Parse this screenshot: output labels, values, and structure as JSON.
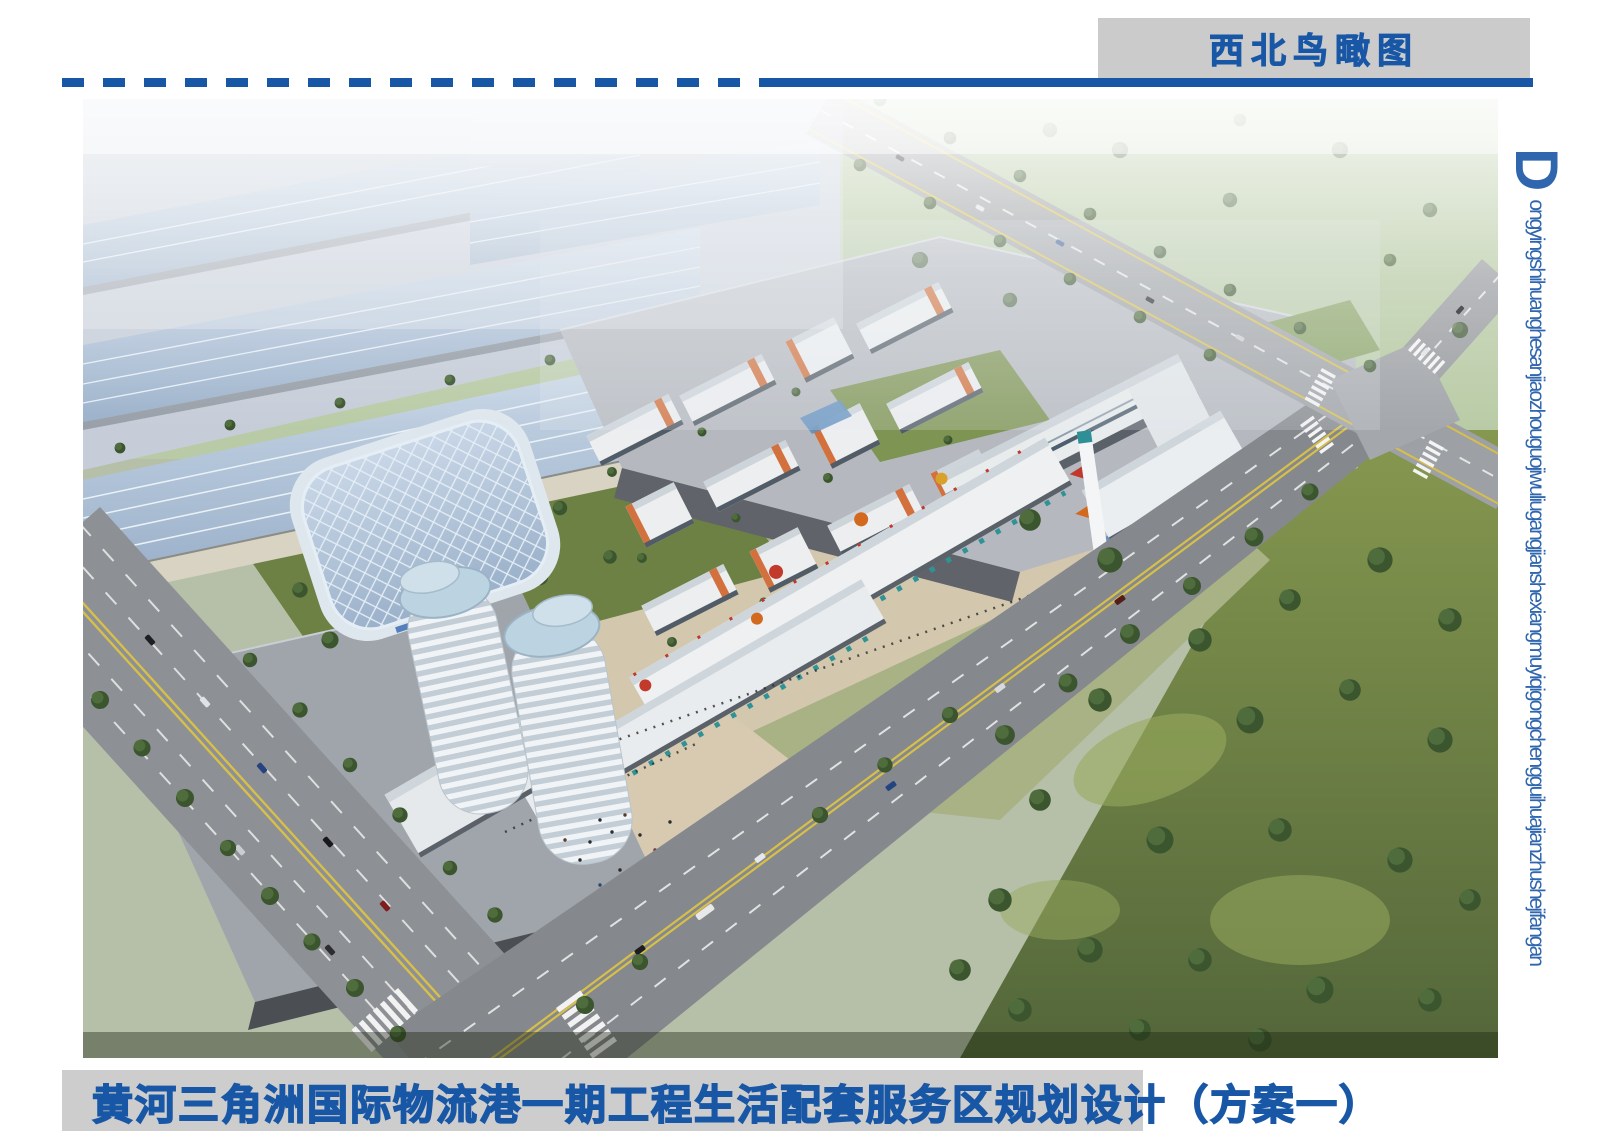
{
  "header": {
    "view_label": "西北鸟瞰图",
    "bar_color": "#cbcbcb",
    "accent_color": "#1856a6"
  },
  "divider": {
    "color": "#1856a6",
    "style": "dashed-then-solid"
  },
  "side_caption": {
    "initial": "D",
    "pinyin": "ongyingshihuanghesanjiaozhouguojiwuliugangjianshexiangmuyiqigongchengguihuajianzhushejifangan",
    "color": "#2f66ae"
  },
  "footer": {
    "project_title": "黄河三角洲国际物流港一期工程生活配套服务区规划设计（方案一）",
    "text_color": "#1856a6",
    "bar_color": "#cdcdcd"
  },
  "rendering": {
    "description": "西北鸟瞰图 — 生活配套服务区整体鸟瞰效果图",
    "palette": {
      "warehouse_roof_blue": "#aec3d9",
      "logistics_gray": "#b5b9bf",
      "campus_white": "#eceef0",
      "accent_orange": "#d2713d",
      "asphalt": "#8d9094",
      "park_green": "#66793f",
      "lawn_green": "#8a9a52",
      "plaza_tan": "#d7cab1",
      "glass_blue": "#b7d2e4",
      "marking_yellow": "#d6bf4a"
    }
  }
}
